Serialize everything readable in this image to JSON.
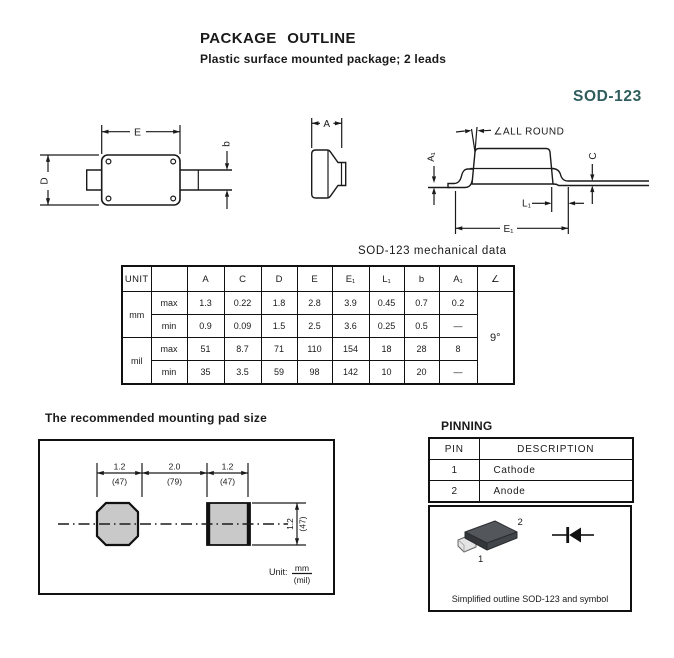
{
  "page": {
    "title": "PACKAGE OUTLINE",
    "subtitle": "Plastic surface mounted package; 2 leads",
    "package_name": "SOD-123"
  },
  "drawings": {
    "top_view": {
      "dim_e": "E",
      "dim_d": "D",
      "dim_b": "b"
    },
    "end_view": {
      "dim_a": "A"
    },
    "side_view": {
      "angle_note": "∠ALL ROUND",
      "dim_a1": "A₁",
      "dim_c": "C",
      "dim_l1": "L₁",
      "dim_e1": "E₁"
    }
  },
  "mech_table": {
    "caption": "SOD-123 mechanical data",
    "headers": [
      "UNIT",
      "",
      "A",
      "C",
      "D",
      "E",
      "E₁",
      "L₁",
      "b",
      "A₁",
      "∠"
    ],
    "row_groups": [
      {
        "unit": "mm",
        "rows": [
          {
            "label": "max",
            "values": [
              "1.3",
              "0.22",
              "1.8",
              "2.8",
              "3.9",
              "0.45",
              "0.7",
              "0.2"
            ]
          },
          {
            "label": "min",
            "values": [
              "0.9",
              "0.09",
              "1.5",
              "2.5",
              "3.6",
              "0.25",
              "0.5",
              "—"
            ]
          }
        ]
      },
      {
        "unit": "mil",
        "rows": [
          {
            "label": "max",
            "values": [
              "51",
              "8.7",
              "71",
              "110",
              "154",
              "18",
              "28",
              "8"
            ]
          },
          {
            "label": "min",
            "values": [
              "35",
              "3.5",
              "59",
              "98",
              "142",
              "10",
              "20",
              "—"
            ]
          }
        ]
      }
    ],
    "angle_value": "9°"
  },
  "mounting_pad": {
    "heading": "The recommended mounting pad size",
    "top_dims": [
      {
        "mm": "1.2",
        "mil": "(47)"
      },
      {
        "mm": "2.0",
        "mil": "(79)"
      },
      {
        "mm": "1.2",
        "mil": "(47)"
      }
    ],
    "side_dim": {
      "mm": "1.2",
      "mil": "(47)"
    },
    "unit_label": "Unit:",
    "unit_numerator": "mm",
    "unit_denominator": "(mil)"
  },
  "pinning": {
    "heading": "PINNING",
    "headers": [
      "PIN",
      "DESCRIPTION"
    ],
    "rows": [
      {
        "pin": "1",
        "description": "Cathode"
      },
      {
        "pin": "2",
        "description": "Anode"
      }
    ]
  },
  "outline_box": {
    "caption": "Simplified outline SOD-123 and symbol",
    "pin1": "1",
    "pin2": "2"
  },
  "colors": {
    "accent": "#2f5d5d",
    "line": "#1a1a1a",
    "pad_fill": "#c9c9c9",
    "body_top": "#53575b",
    "body_left": "#33363a",
    "body_right": "#42464a",
    "lead_fill": "#e4e4e4"
  }
}
